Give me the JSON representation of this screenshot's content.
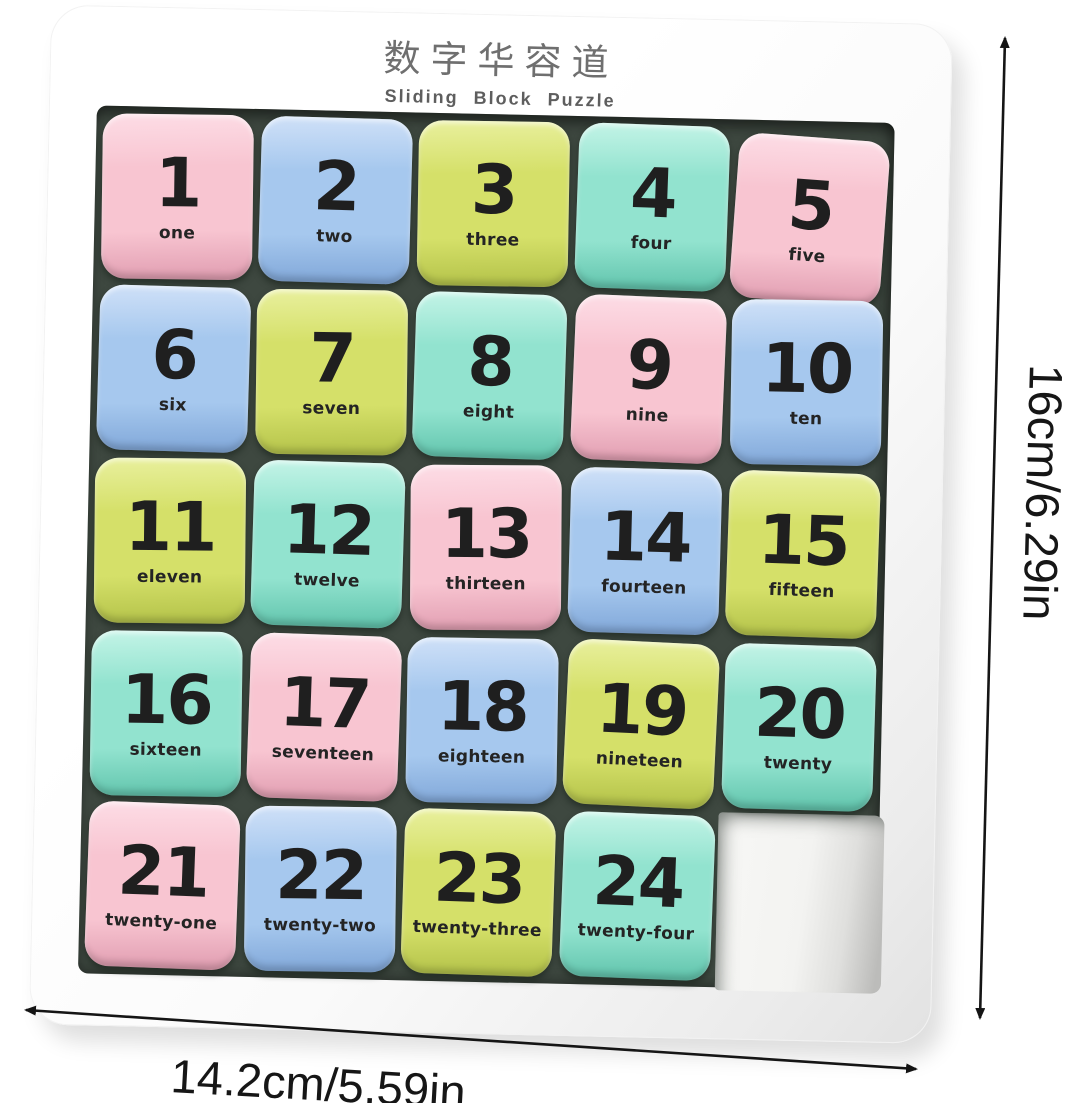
{
  "header": {
    "title_cn": "数字华容道",
    "title_en": "Sliding Block Puzzle"
  },
  "dimensions": {
    "height_label": "16cm/6.29in",
    "width_label": "14.2cm/5.59in"
  },
  "palette": {
    "pink": {
      "base": "#f8c5d1",
      "light": "#fddde6",
      "edge": "#e09cb0"
    },
    "blue": {
      "base": "#a6c8ee",
      "light": "#d0e1f8",
      "edge": "#7fa6d8"
    },
    "green": {
      "base": "#d5e069",
      "light": "#e9f09e",
      "edge": "#b2c148"
    },
    "mint": {
      "base": "#92e3cf",
      "light": "#c4f4e7",
      "edge": "#5fc3ab"
    }
  },
  "puzzle": {
    "rows": 5,
    "cols": 5,
    "empty_position": 25,
    "tiles": [
      {
        "n": "1",
        "word": "one",
        "color": "pink"
      },
      {
        "n": "2",
        "word": "two",
        "color": "blue"
      },
      {
        "n": "3",
        "word": "three",
        "color": "green"
      },
      {
        "n": "4",
        "word": "four",
        "color": "mint"
      },
      {
        "n": "5",
        "word": "five",
        "color": "pink"
      },
      {
        "n": "6",
        "word": "six",
        "color": "blue"
      },
      {
        "n": "7",
        "word": "seven",
        "color": "green"
      },
      {
        "n": "8",
        "word": "eight",
        "color": "mint"
      },
      {
        "n": "9",
        "word": "nine",
        "color": "pink"
      },
      {
        "n": "10",
        "word": "ten",
        "color": "blue"
      },
      {
        "n": "11",
        "word": "eleven",
        "color": "green"
      },
      {
        "n": "12",
        "word": "twelve",
        "color": "mint"
      },
      {
        "n": "13",
        "word": "thirteen",
        "color": "pink"
      },
      {
        "n": "14",
        "word": "fourteen",
        "color": "blue"
      },
      {
        "n": "15",
        "word": "fifteen",
        "color": "green"
      },
      {
        "n": "16",
        "word": "sixteen",
        "color": "mint"
      },
      {
        "n": "17",
        "word": "seventeen",
        "color": "pink"
      },
      {
        "n": "18",
        "word": "eighteen",
        "color": "blue"
      },
      {
        "n": "19",
        "word": "nineteen",
        "color": "green"
      },
      {
        "n": "20",
        "word": "twenty",
        "color": "mint"
      },
      {
        "n": "21",
        "word": "twenty-one",
        "color": "pink"
      },
      {
        "n": "22",
        "word": "twenty-two",
        "color": "blue"
      },
      {
        "n": "23",
        "word": "twenty-three",
        "color": "green"
      },
      {
        "n": "24",
        "word": "twenty-four",
        "color": "mint"
      }
    ]
  }
}
